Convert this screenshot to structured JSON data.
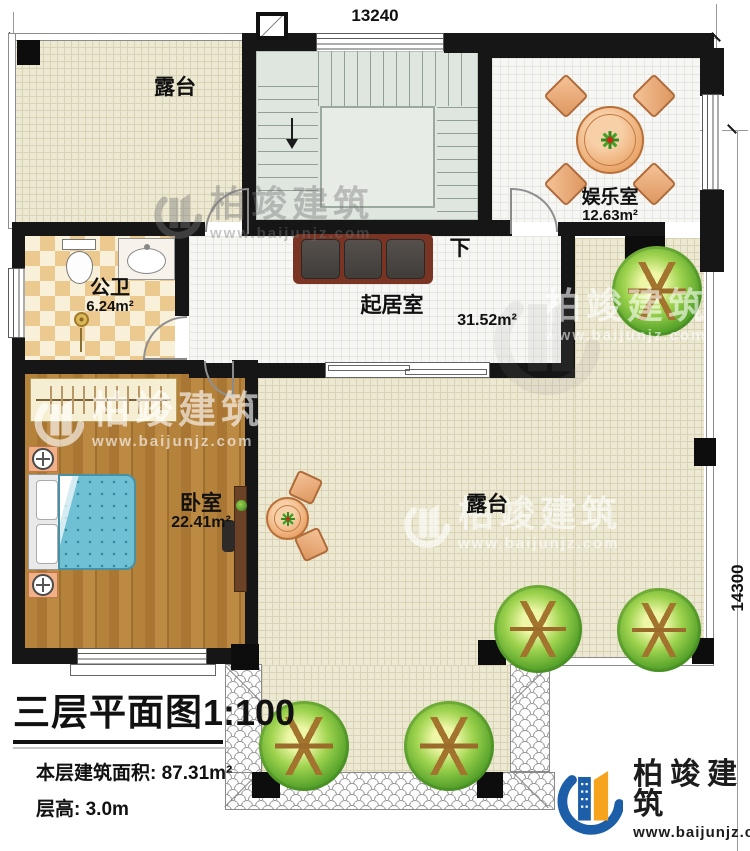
{
  "dimensions": {
    "top": "13240",
    "right": "14300"
  },
  "rooms": {
    "terrace_top": {
      "name": "露台"
    },
    "entertainment": {
      "name": "娱乐室",
      "area": "12.63m²"
    },
    "bathroom": {
      "name": "公卫",
      "area": "6.24m²"
    },
    "living": {
      "name": "起居室",
      "area": "31.52m²"
    },
    "bedroom": {
      "name": "卧室",
      "area": "22.41m²"
    },
    "terrace_main": {
      "name": "露台"
    }
  },
  "stairs": {
    "direction_label": "下"
  },
  "title_block": {
    "title": "三层平面图",
    "scale": "1:100",
    "area_line": "本层建筑面积: 87.31m²",
    "height_line": "层高: 3.0m"
  },
  "branding": {
    "watermark_brand": "柏竣建筑",
    "watermark_url": "www.baijunjz.com",
    "logo_brand": "柏竣建筑",
    "logo_url": "www.baijunjz.com"
  },
  "icons": {
    "logo_mark": "building-with-swoosh",
    "tree": "round-tree-plan-symbol",
    "lamp": "bedside-lamp-plan-symbol",
    "down_arrow": "stair-direction-arrow"
  },
  "colors": {
    "wall": "#161616",
    "terrace_floor": "#ece8d2",
    "stair_floor": "#dfe5df",
    "wood_floor": "#b5823c",
    "bed_blue": "#70c0d4",
    "furniture_peach": "#eba86e",
    "tree_green": "#57a32b",
    "logo_blue": "#1c5fa8",
    "logo_orange": "#f6a41d"
  }
}
